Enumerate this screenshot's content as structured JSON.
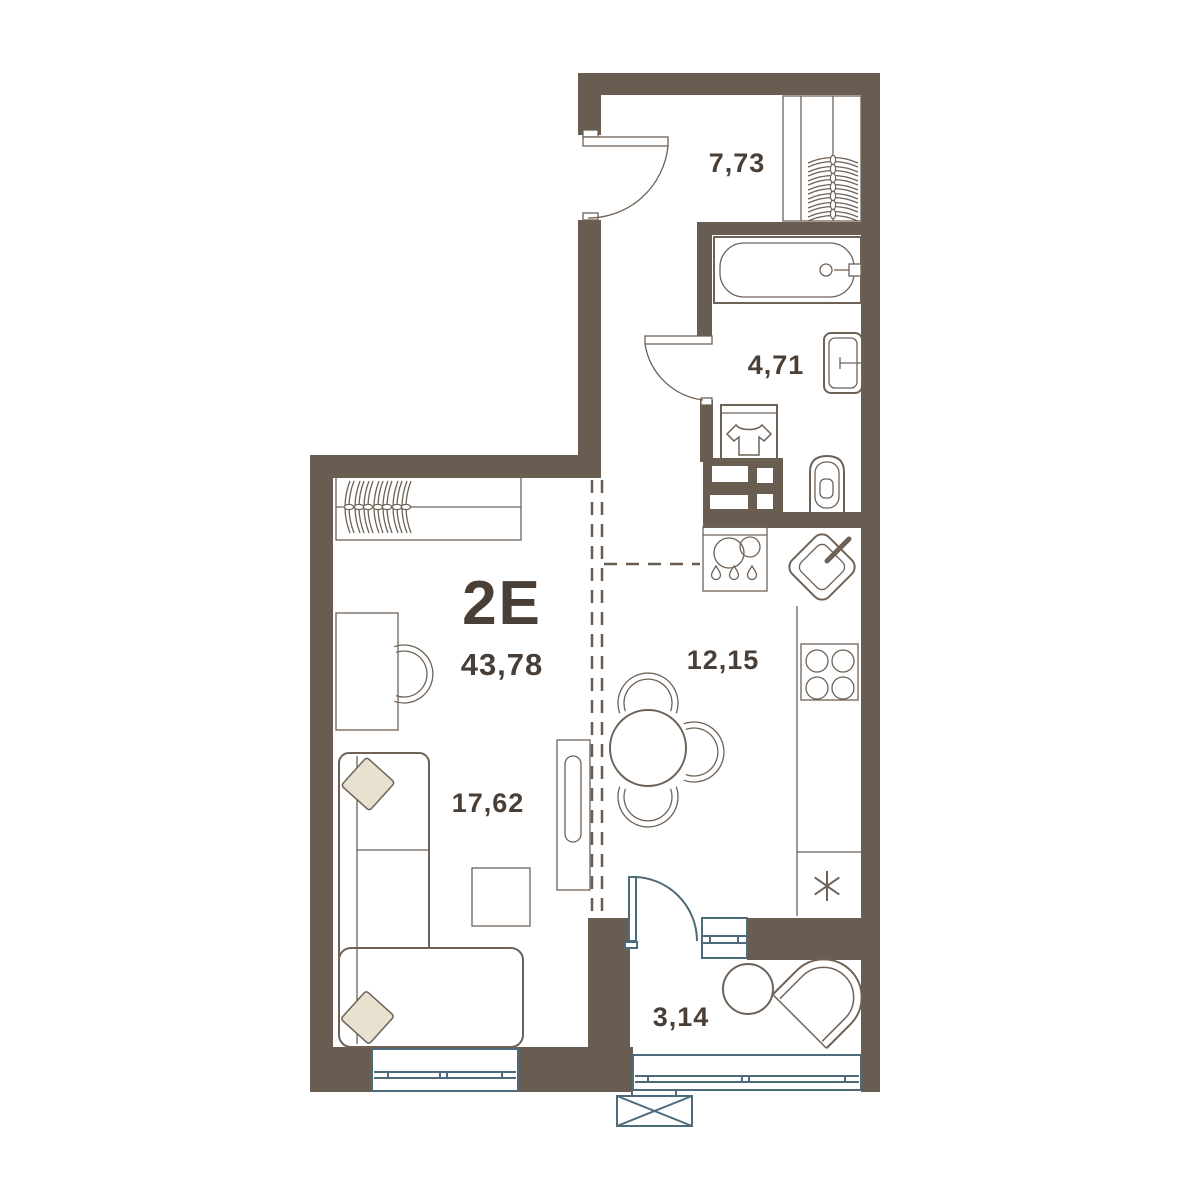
{
  "floorplan": {
    "unit_label": "2Е",
    "total_area": "43,78",
    "rooms": [
      {
        "id": "hallway",
        "area": "7,73",
        "fixtures": [
          "entrance-door",
          "wardrobe-hangers"
        ]
      },
      {
        "id": "bathroom",
        "area": "4,71",
        "fixtures": [
          "bathtub",
          "washbasin",
          "washing-machine",
          "toilet",
          "ventilation-shaft",
          "bathroom-door"
        ]
      },
      {
        "id": "kitchen",
        "area": "12,15",
        "fixtures": [
          "dishwasher-unit",
          "corner-sink",
          "cooktop-4-burner",
          "refrigerator-asterisk",
          "dining-table",
          "dining-chairs"
        ]
      },
      {
        "id": "living-room",
        "area": "17,62",
        "fixtures": [
          "wardrobe-hangers",
          "desk",
          "desk-chair",
          "corner-sofa",
          "pillows",
          "coffee-table",
          "tv-stand",
          "window"
        ]
      },
      {
        "id": "balcony",
        "area": "3,14",
        "fixtures": [
          "balcony-door",
          "round-table",
          "armchair",
          "glazing-band",
          "small-window",
          "ac-unit-basket"
        ]
      }
    ],
    "colors": {
      "wall": "#695d52",
      "line": "#6e6257",
      "glazing": "#4d6b7b",
      "pillow": "#e9e1d0",
      "text": "#493f37",
      "background": "#ffffff"
    }
  }
}
